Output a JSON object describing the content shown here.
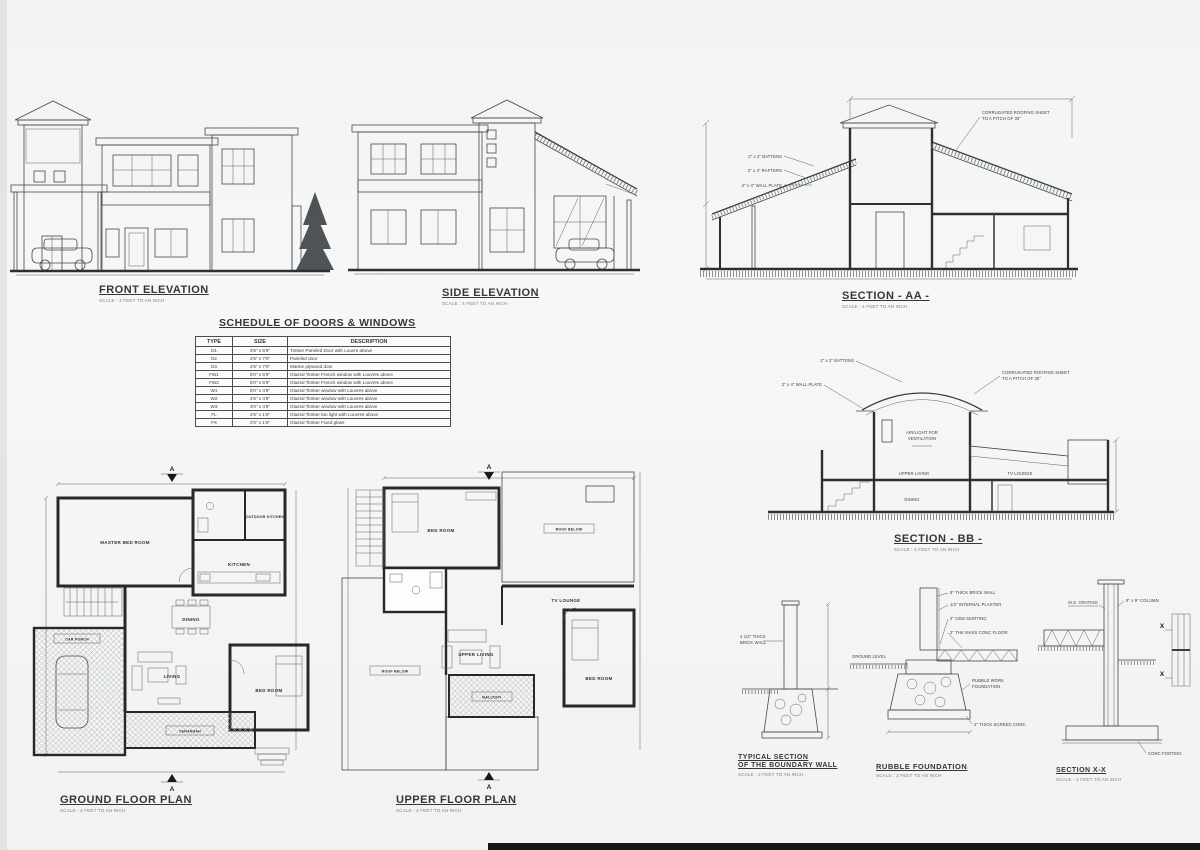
{
  "sheet": {
    "paper": "#f3f4f3",
    "ink": "#3b3f44"
  },
  "front_elevation": {
    "title": "FRONT ELEVATION",
    "scale_note": "SCALE : 4 FEET TO AN INCH"
  },
  "side_elevation": {
    "title": "SIDE ELEVATION",
    "scale_note": "SCALE : 4 FEET TO AN INCH"
  },
  "section_aa": {
    "title": "SECTION - AA -",
    "scale_note": "SCALE : 4 FEET TO AN INCH",
    "ann": {
      "rafters": "2\" x 4\" RAFTERS",
      "battens": "2\" x 2\" BATTENS",
      "wall_plate": "2\" x 4\" WALL PLATE",
      "roof_sheet_1": "CORRUGATED ROOFING SHEET",
      "roof_sheet_2": "TO A PITCH OF 30°"
    }
  },
  "section_bb": {
    "title": "SECTION - BB -",
    "scale_note": "SCALE : 4 FEET TO AN INCH",
    "ann": {
      "battens": "2\" x 2\" BATTENS",
      "wall_plate": "2\" x 4\" WALL PLATE",
      "roof_sheet_1": "CORRUGATED ROOFING SHEET",
      "roof_sheet_2": "TO A PITCH OF 30°",
      "vent_1": "AIR/LIGHT FOR",
      "vent_2": "VENTILATION"
    },
    "rooms": {
      "upper_living": "UPPER LIVING",
      "tv_lounge": "TV LOUNGE",
      "dining": "DINING"
    }
  },
  "schedule": {
    "title": "SCHEDULE OF DOORS & WINDOWS",
    "headers": [
      "TYPE",
      "SIZE",
      "DESCRIPTION"
    ],
    "rows": [
      [
        "D1",
        "3'6\" x 6'6\"",
        "Timber Paneled Door with Louvre above"
      ],
      [
        "D2",
        "2'6\" x 7'0\"",
        "Paneled door"
      ],
      [
        "D3",
        "2'6\" x 7'0\"",
        "Marine plywood door"
      ],
      [
        "FW1",
        "6'0\" x 6'6\"",
        "Glazed Timber French window with Louvres above"
      ],
      [
        "FW2",
        "5'0\" x 6'6\"",
        "Glazed Timber French window with Louvres above"
      ],
      [
        "W1",
        "6'0\" x 4'6\"",
        "Glazed Timber window with Louvres above"
      ],
      [
        "W2",
        "4'6\" x 4'6\"",
        "Glazed Timber window with Louvres above"
      ],
      [
        "W3",
        "3'0\" x 4'6\"",
        "Glazed Timber window with Louvres above"
      ],
      [
        "FL",
        "2'6\" x 1'6\"",
        "Glazed Timber fan light with Louvres above"
      ],
      [
        "FX",
        "2'0\" x 1'6\"",
        "Glazed Timber Fixed glass"
      ]
    ]
  },
  "ground_plan": {
    "title": "GROUND FLOOR PLAN",
    "scale_note": "SCALE : 4 FEET TO AN INCH",
    "marker": "A",
    "rooms": {
      "master": "MASTER BED ROOM",
      "outdoor_kitchen": "OUTDOOR KITCHEN",
      "kitchen": "KITCHEN",
      "dining": "DINING",
      "living": "LIVING",
      "bed": "BED ROOM",
      "car_porch": "CAR PORCH",
      "verandah": "VERANDAH"
    }
  },
  "upper_plan": {
    "title": "UPPER FLOOR PLAN",
    "scale_note": "SCALE : 4 FEET TO AN INCH",
    "marker": "A",
    "rooms": {
      "bed1": "BED ROOM",
      "roof_right": "ROOF BELOW",
      "tv_lounge": "TV LOUNGE",
      "upper_living": "UPPER LIVING",
      "bed2": "BED ROOM",
      "balcony": "BALCONY",
      "roof_left": "ROOF BELOW"
    }
  },
  "boundary_wall": {
    "title_1": "TYPICAL SECTION",
    "title_2": "OF THE BOUNDARY WALL",
    "scale_note": "SCALE : 2 FEET TO AN INCH",
    "ann": {
      "wall_1": "4 1/2\" THICK",
      "wall_2": "BRICK WALL"
    }
  },
  "rubble_foundation": {
    "title": "RUBBLE FOUNDATION",
    "scale_note": "SCALE : 2 FEET TO AN INCH",
    "ann": {
      "brick_wall": "9\" THICK BRICK WALL",
      "plaster": "1/2\" INTERNAL PLASTER",
      "skirting": "2\" CEM SKIRTING",
      "floor": "3\" THK MASS CONC FLOOR",
      "ground": "GROUND LEVEL",
      "rubble_1": "RUBBLE WORK",
      "rubble_2": "FOUNDATION",
      "screed": "2\" THICK SCREED CONC"
    }
  },
  "section_xx": {
    "title": "SECTION X-X",
    "scale_note": "SCALE : 2 FEET TO AN INCH",
    "ann": {
      "grating": "M.S. GRATING",
      "column": "9\" x 9\" COLUMN",
      "footing": "CONC FOOTING",
      "cut": "X"
    }
  }
}
